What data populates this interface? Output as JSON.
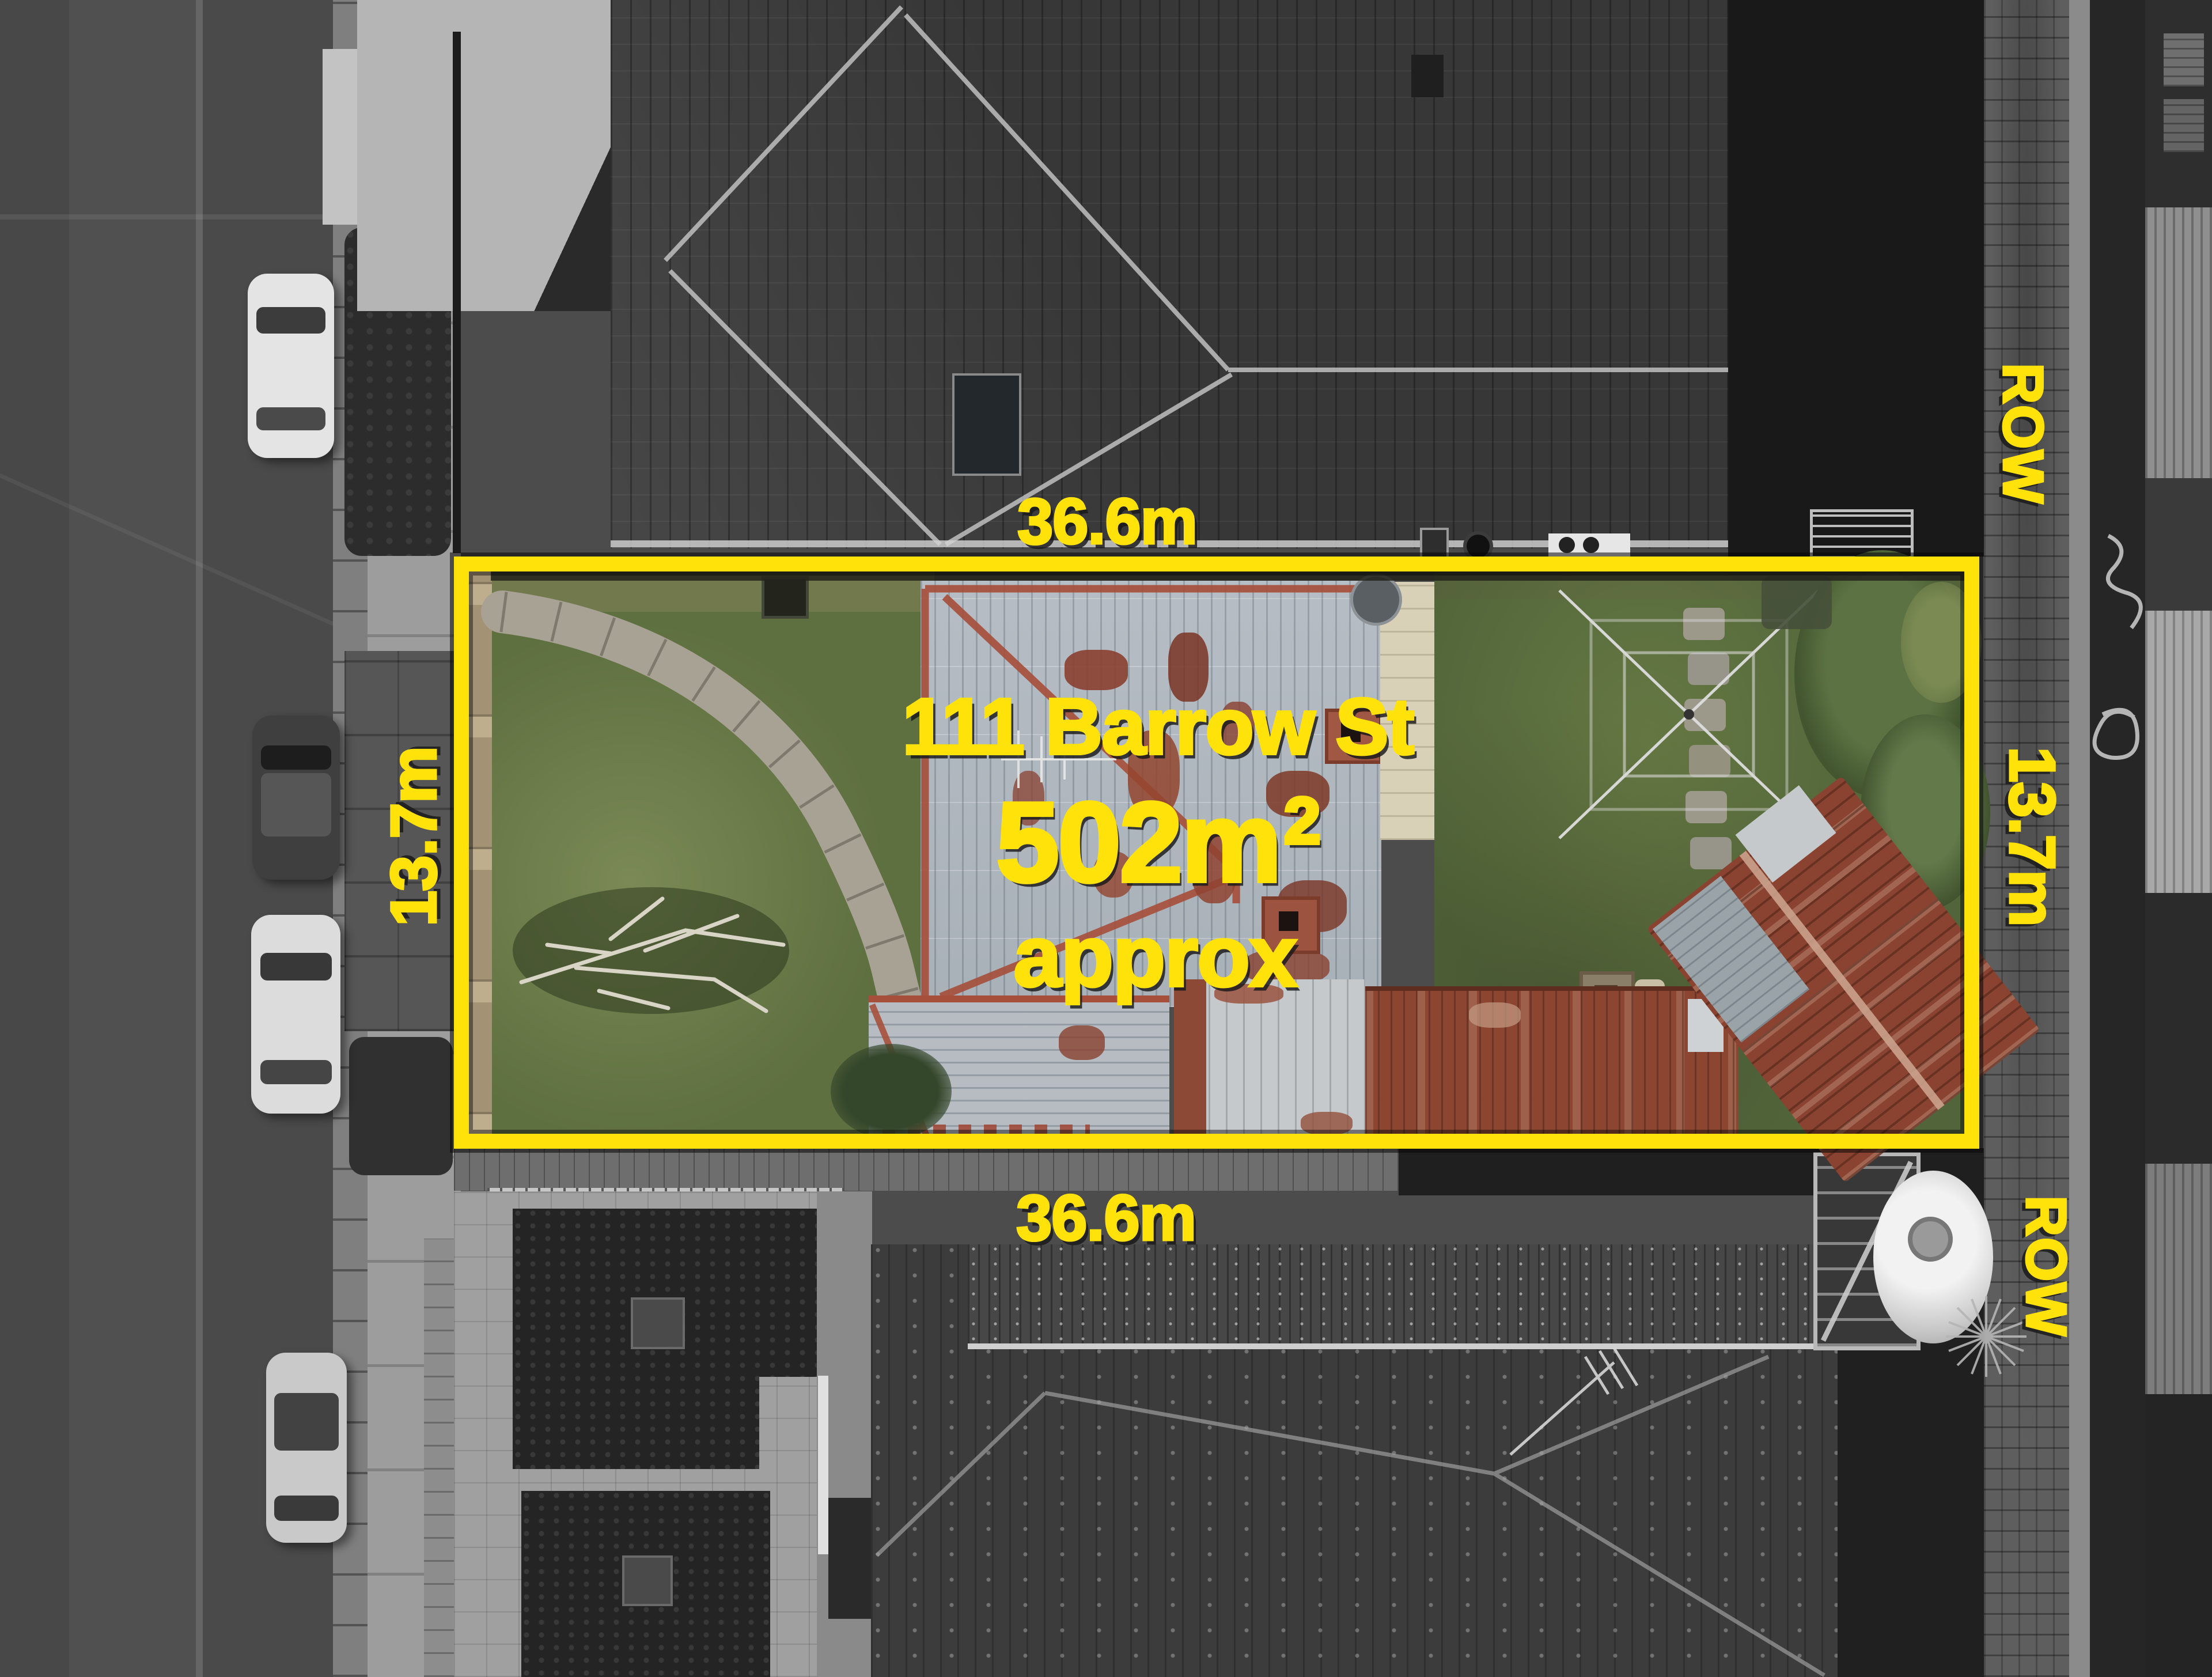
{
  "scene": {
    "description": "Overhead drone photograph of a property; surroundings desaturated, subject lot in colour inside a yellow boundary"
  },
  "annotations": {
    "address": "111 Barrow St",
    "area_value": "502m",
    "area_exponent": "2",
    "area_qualifier": "approx",
    "frontage_top": "36.6m",
    "frontage_bottom": "36.6m",
    "depth_left": "13.7m",
    "depth_right": "13.7m",
    "row_top": "ROW",
    "row_bottom": "ROW"
  },
  "colors": {
    "highlight_yellow": "#FFE20A",
    "label_shadow": "#1E1E1E"
  }
}
